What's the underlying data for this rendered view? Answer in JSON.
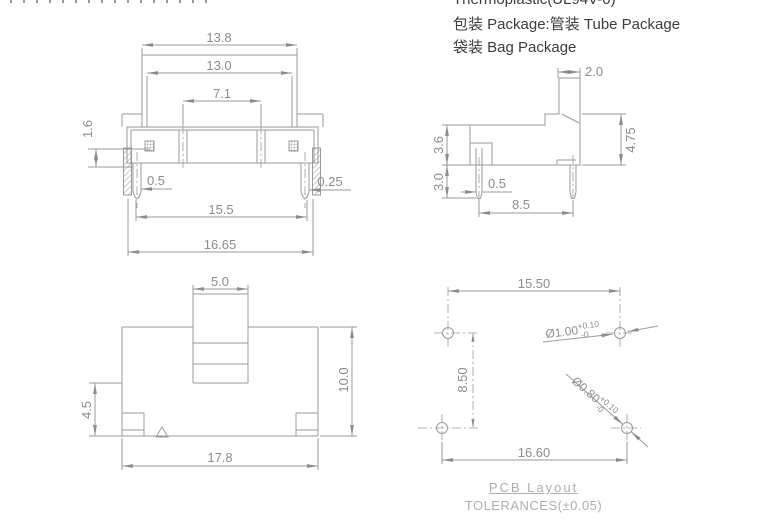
{
  "notes": {
    "material": "Thermoplastic(UL94V-0)",
    "package1": "包装 Package:管装 Tube Package",
    "package2": "袋装 Bag Package"
  },
  "front_view": {
    "dims": {
      "top_width": "13.8",
      "knob_width": "13.0",
      "pole_pitch": "7.1",
      "terminal_height": "1.6",
      "left_pin_width": "0.5",
      "right_pin_width": "0.25",
      "pin_span": "15.5",
      "overall_width": "16.65"
    }
  },
  "side_view": {
    "dims": {
      "actuator_width": "2.0",
      "overall_height": "4.75",
      "body_height": "3.6",
      "pin_length": "3.0",
      "pin_width": "0.5",
      "pin_pitch": "8.5"
    }
  },
  "top_view": {
    "dims": {
      "knob_width": "5.0",
      "body_depth": "10.0",
      "knob_offset": "4.5",
      "body_length": "17.8"
    }
  },
  "pcb_layout": {
    "title": "PCB Layout",
    "tolerance_note": "TOLERANCES(±0.05)",
    "dims": {
      "top_hole_pitch": "15.50",
      "row_pitch": "8.50",
      "bottom_hole_pitch": "16.60"
    },
    "hole_large": {
      "diameter": "Ø1.00",
      "tol_upper": "+0.10",
      "tol_lower": "-0"
    },
    "hole_small": {
      "diameter": "Ø0.80",
      "tol_upper": "+0.10",
      "tol_lower": "-0"
    }
  },
  "colors": {
    "line": "#9a9a9a",
    "dim_text": "#8c8c8c",
    "note_text": "#3c3c3c",
    "footer_text": "#aeaeae",
    "background": "#ffffff"
  }
}
